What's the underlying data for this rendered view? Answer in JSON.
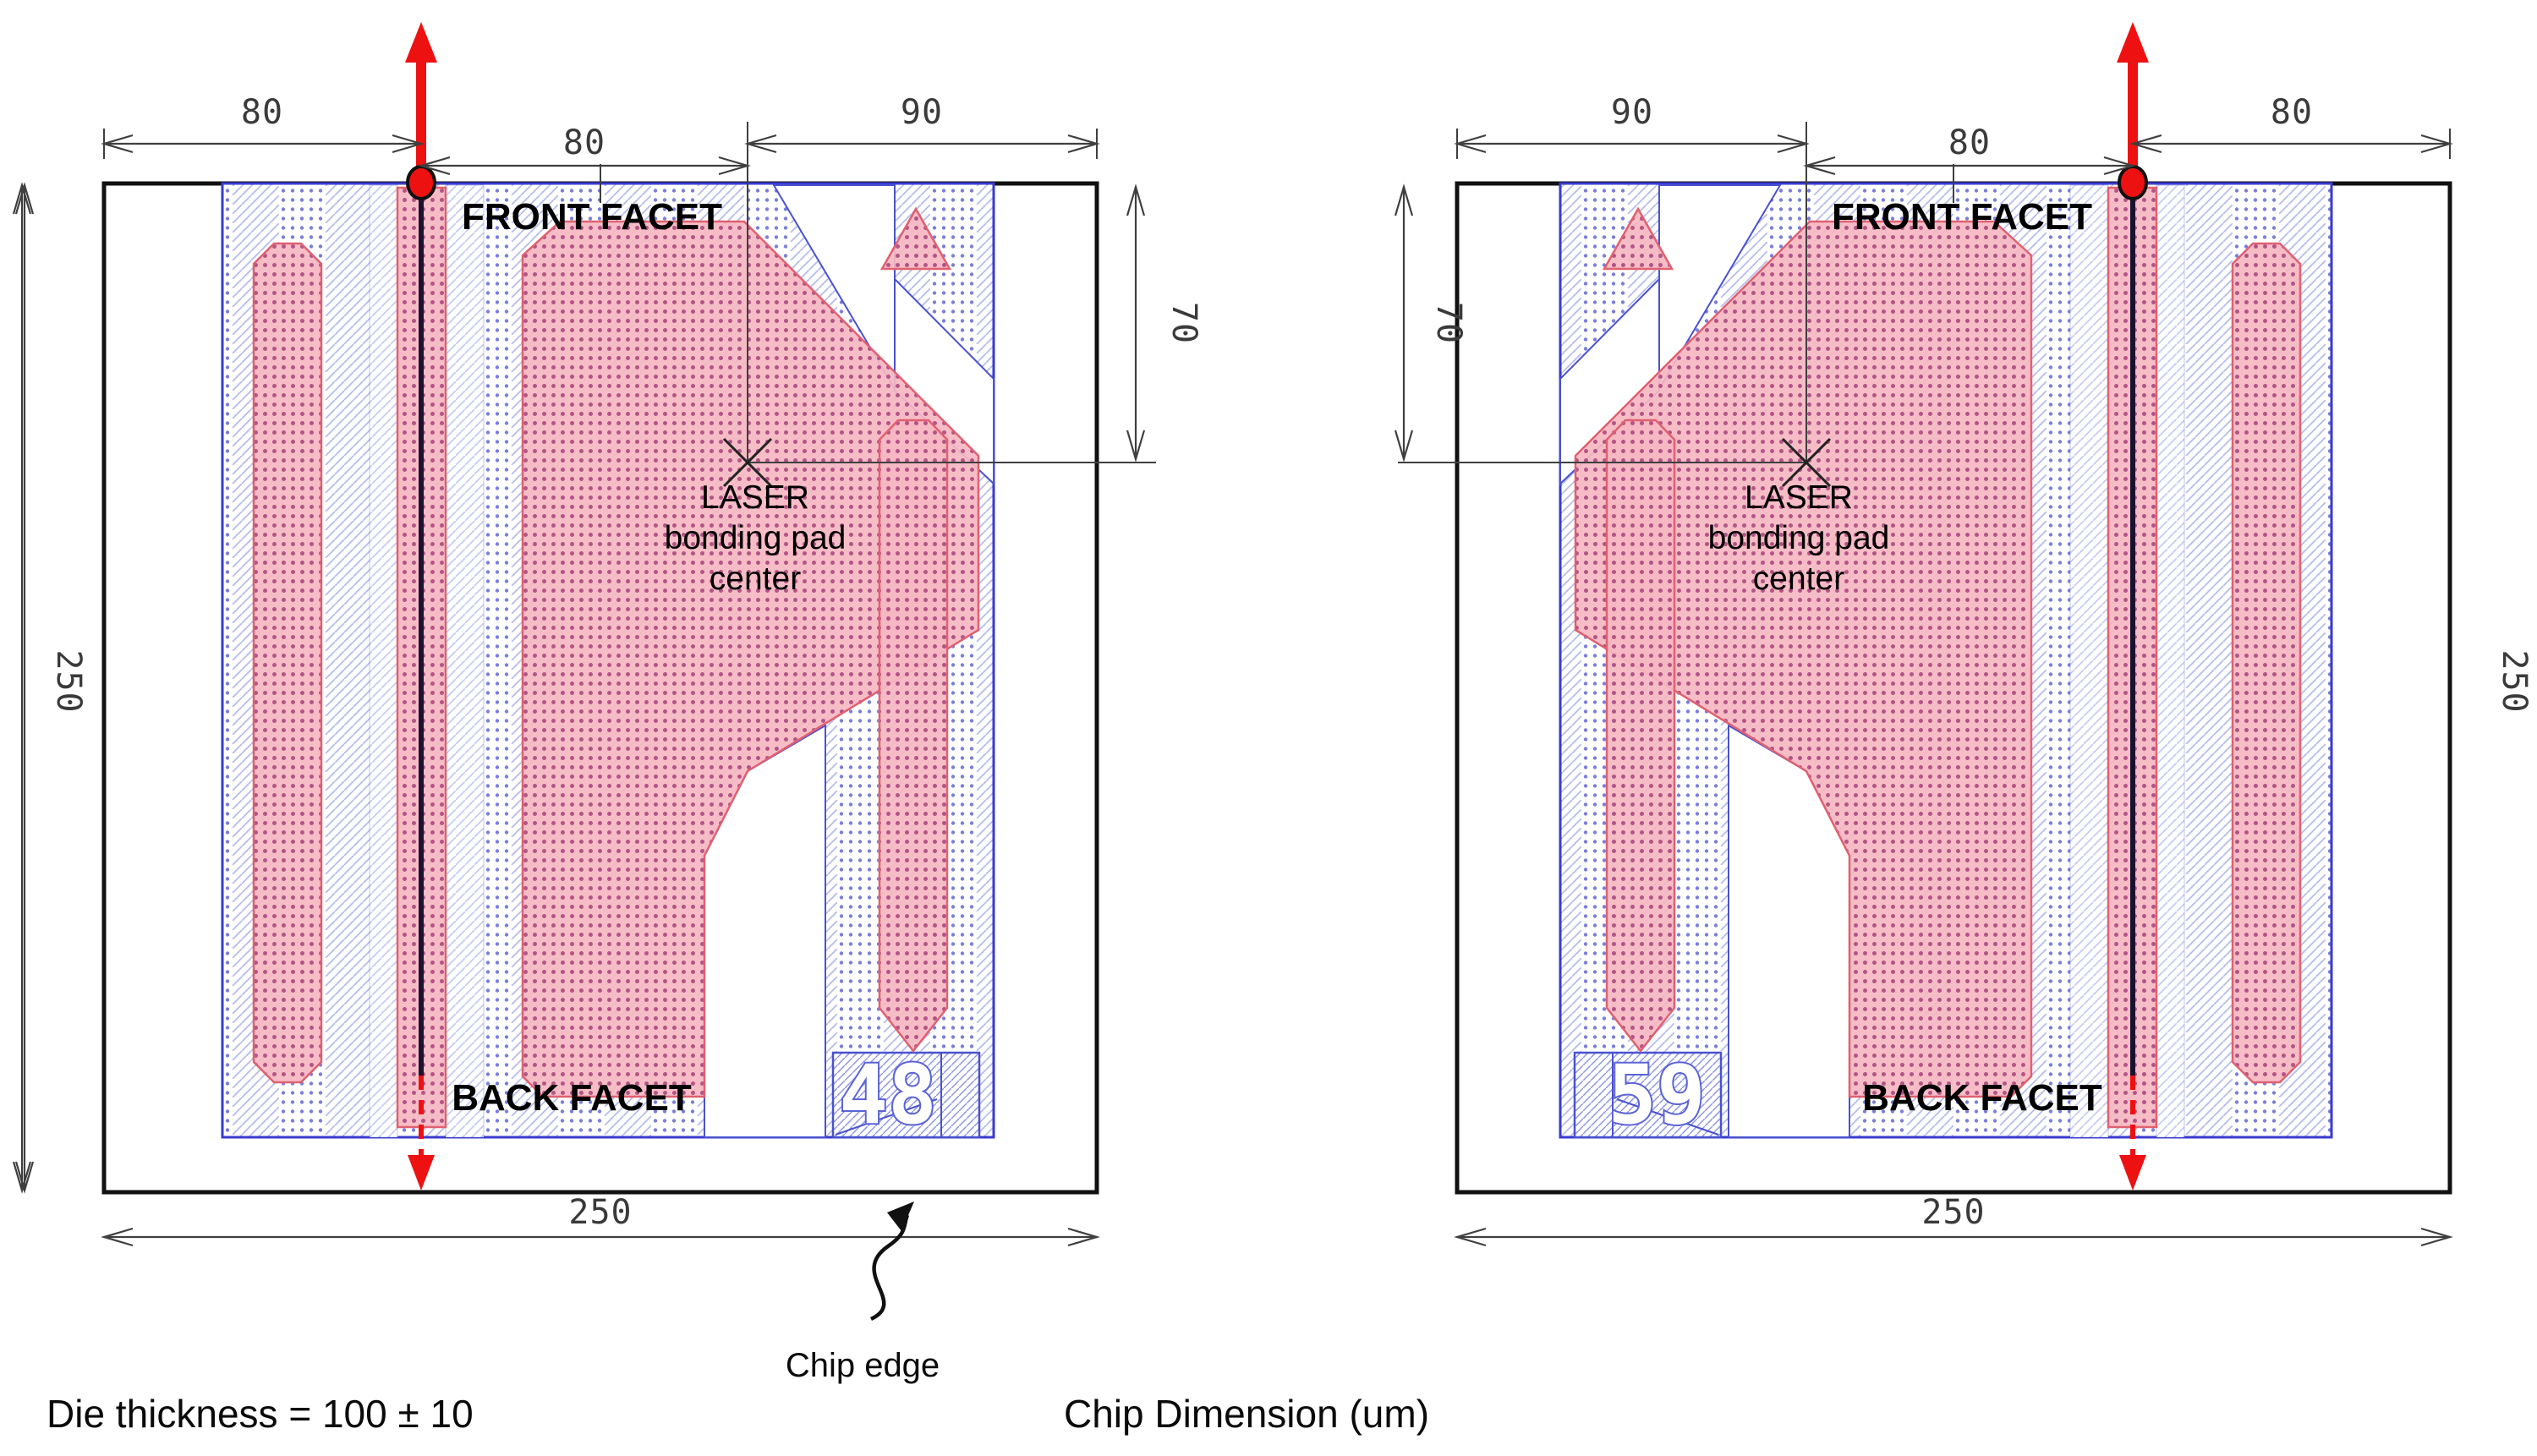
{
  "chips": [
    {
      "id": "left",
      "front_facet_label": "FRONT FACET",
      "back_facet_label": "BACK FACET",
      "pad_center_label_lines": [
        "LASER",
        "bonding pad",
        "center"
      ],
      "chip_number": "48",
      "dimensions": {
        "top_left": "80",
        "top_middle": "80",
        "top_right": "90",
        "facet_to_pad_center": "70",
        "side_height": "250",
        "bottom_width": "250"
      }
    },
    {
      "id": "right",
      "front_facet_label": "FRONT FACET",
      "back_facet_label": "BACK FACET",
      "pad_center_label_lines": [
        "LASER",
        "bonding pad",
        "center"
      ],
      "chip_number": "59",
      "dimensions": {
        "top_left": "90",
        "top_middle": "80",
        "top_right": "80",
        "facet_to_pad_center": "70",
        "side_height": "250",
        "bottom_width": "250"
      }
    }
  ],
  "annotations": {
    "die_thickness": "Die thickness = 100 ± 10",
    "chip_edge": "Chip edge",
    "chip_dimension_units": "Chip Dimension (um)"
  },
  "colors": {
    "outline": "#111111",
    "dimension_line": "#3f3f3f",
    "blue_edge": "#3a3ad0",
    "blue_edge_light": "#4a52d0",
    "blue_dot": "#7b7fd8",
    "blue_diag": "#b4bbe8",
    "strip_diag": "#c5cbef",
    "box_diag": "#8b93dd",
    "pink_fill": "rgba(246,183,194,0.92)",
    "pink_dot": "#a8437a",
    "pink_edge": "#e06070",
    "laser_red": "#ee1111",
    "waveguide": "#1a1230"
  }
}
